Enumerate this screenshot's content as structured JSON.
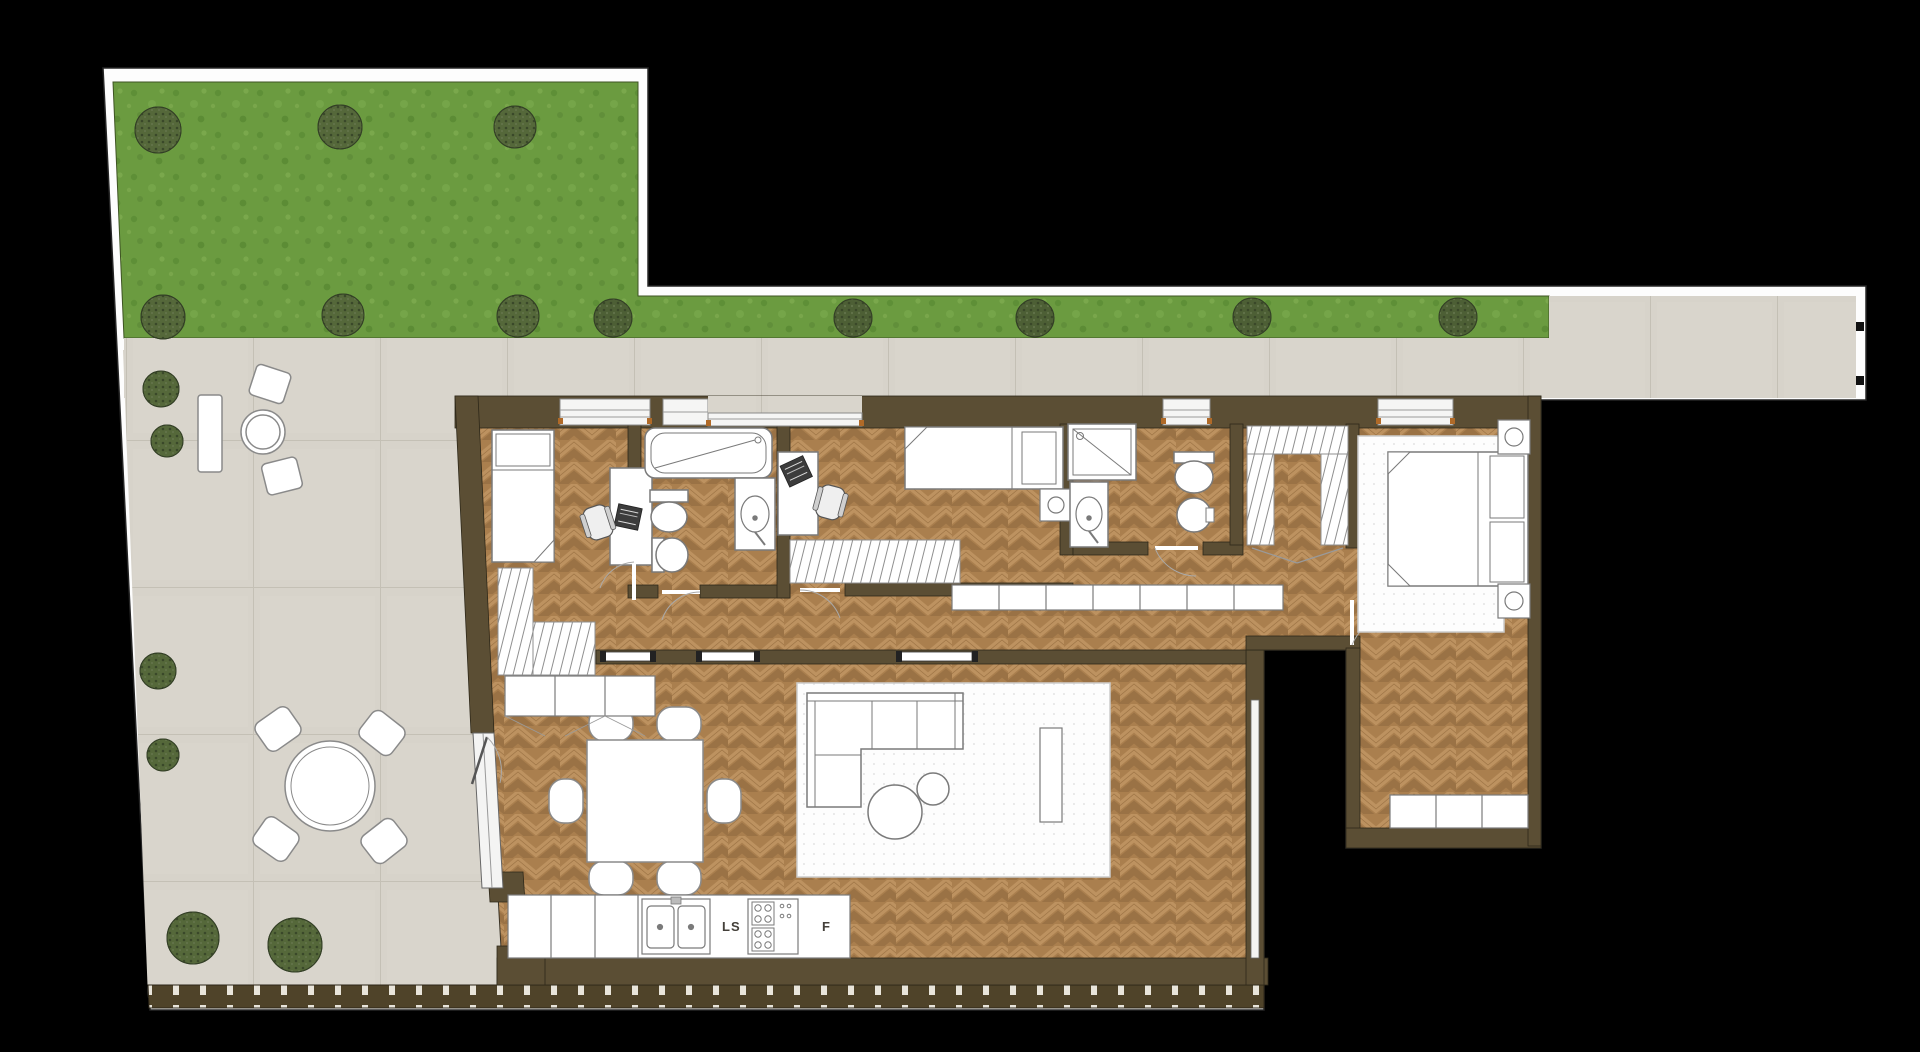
{
  "plan": {
    "type": "apartment-floor-plan-top-view",
    "labels": {
      "sink_unit": "LS",
      "fridge": "F"
    },
    "colors": {
      "background": "#000000",
      "plot_border": "#fdfdfd",
      "lawn": "#6b9b40",
      "lawn_shade": "#5e8f37",
      "bush": "#55683a",
      "paving": "#d7d3ca",
      "paving_joint": "#c4c0b5",
      "wall": "#5b4e34",
      "wood_base": "#aa7f4e",
      "wood_light": "#bd9260",
      "wood_dark": "#9a7245",
      "fixture": "#ffffff",
      "fixture_outline": "#7a7a7a",
      "fence": "#4f4329",
      "rug": "#fdfdfd",
      "window_frame": "#8a8a8a",
      "threshold_tick": "#b06a28"
    }
  }
}
